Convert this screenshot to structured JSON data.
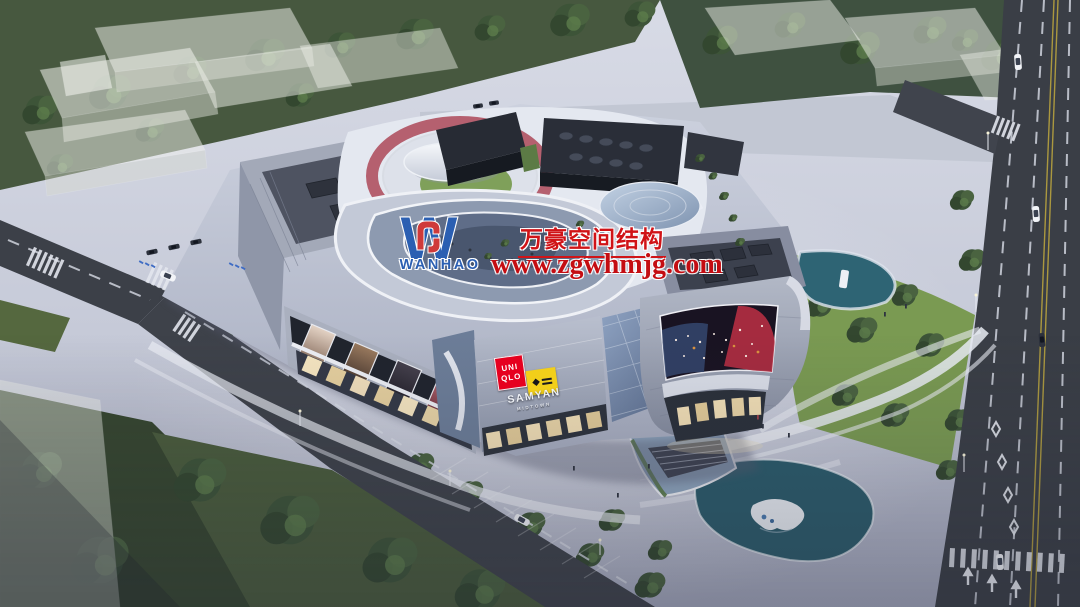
{
  "scene": {
    "type": "aerial architectural rendering",
    "subject": "Dusk aerial rendering of a shopping-mall complex with rooftop running track, terraced atrium, LED media screen, surrounding roads, plazas and landscaping"
  },
  "watermark": {
    "logo_monogram": "W",
    "brand": "WANHAO",
    "company_name_cn": "万豪空间结构",
    "website": "www.zgwhmjg.com",
    "logo_blue": "#2b5fb2",
    "logo_red": "#cf3a3a",
    "text_red": "#d01317"
  },
  "signage": {
    "uniqlo_line1": "UNI",
    "uniqlo_line2": "QLO",
    "uniqlo_bg": "#e6001f",
    "gem_icon": "◆",
    "gem_bg": "#f2cf1a",
    "mall_line1": "SAMYAN",
    "mall_line2": "MIDTOWN"
  },
  "palette": {
    "track_pink": "#b5606f",
    "pond_teal": "#2b5b6b",
    "lawn_green": "#7a9a52",
    "road_asphalt": "#3c4048",
    "plaza": "#c9cedb"
  }
}
